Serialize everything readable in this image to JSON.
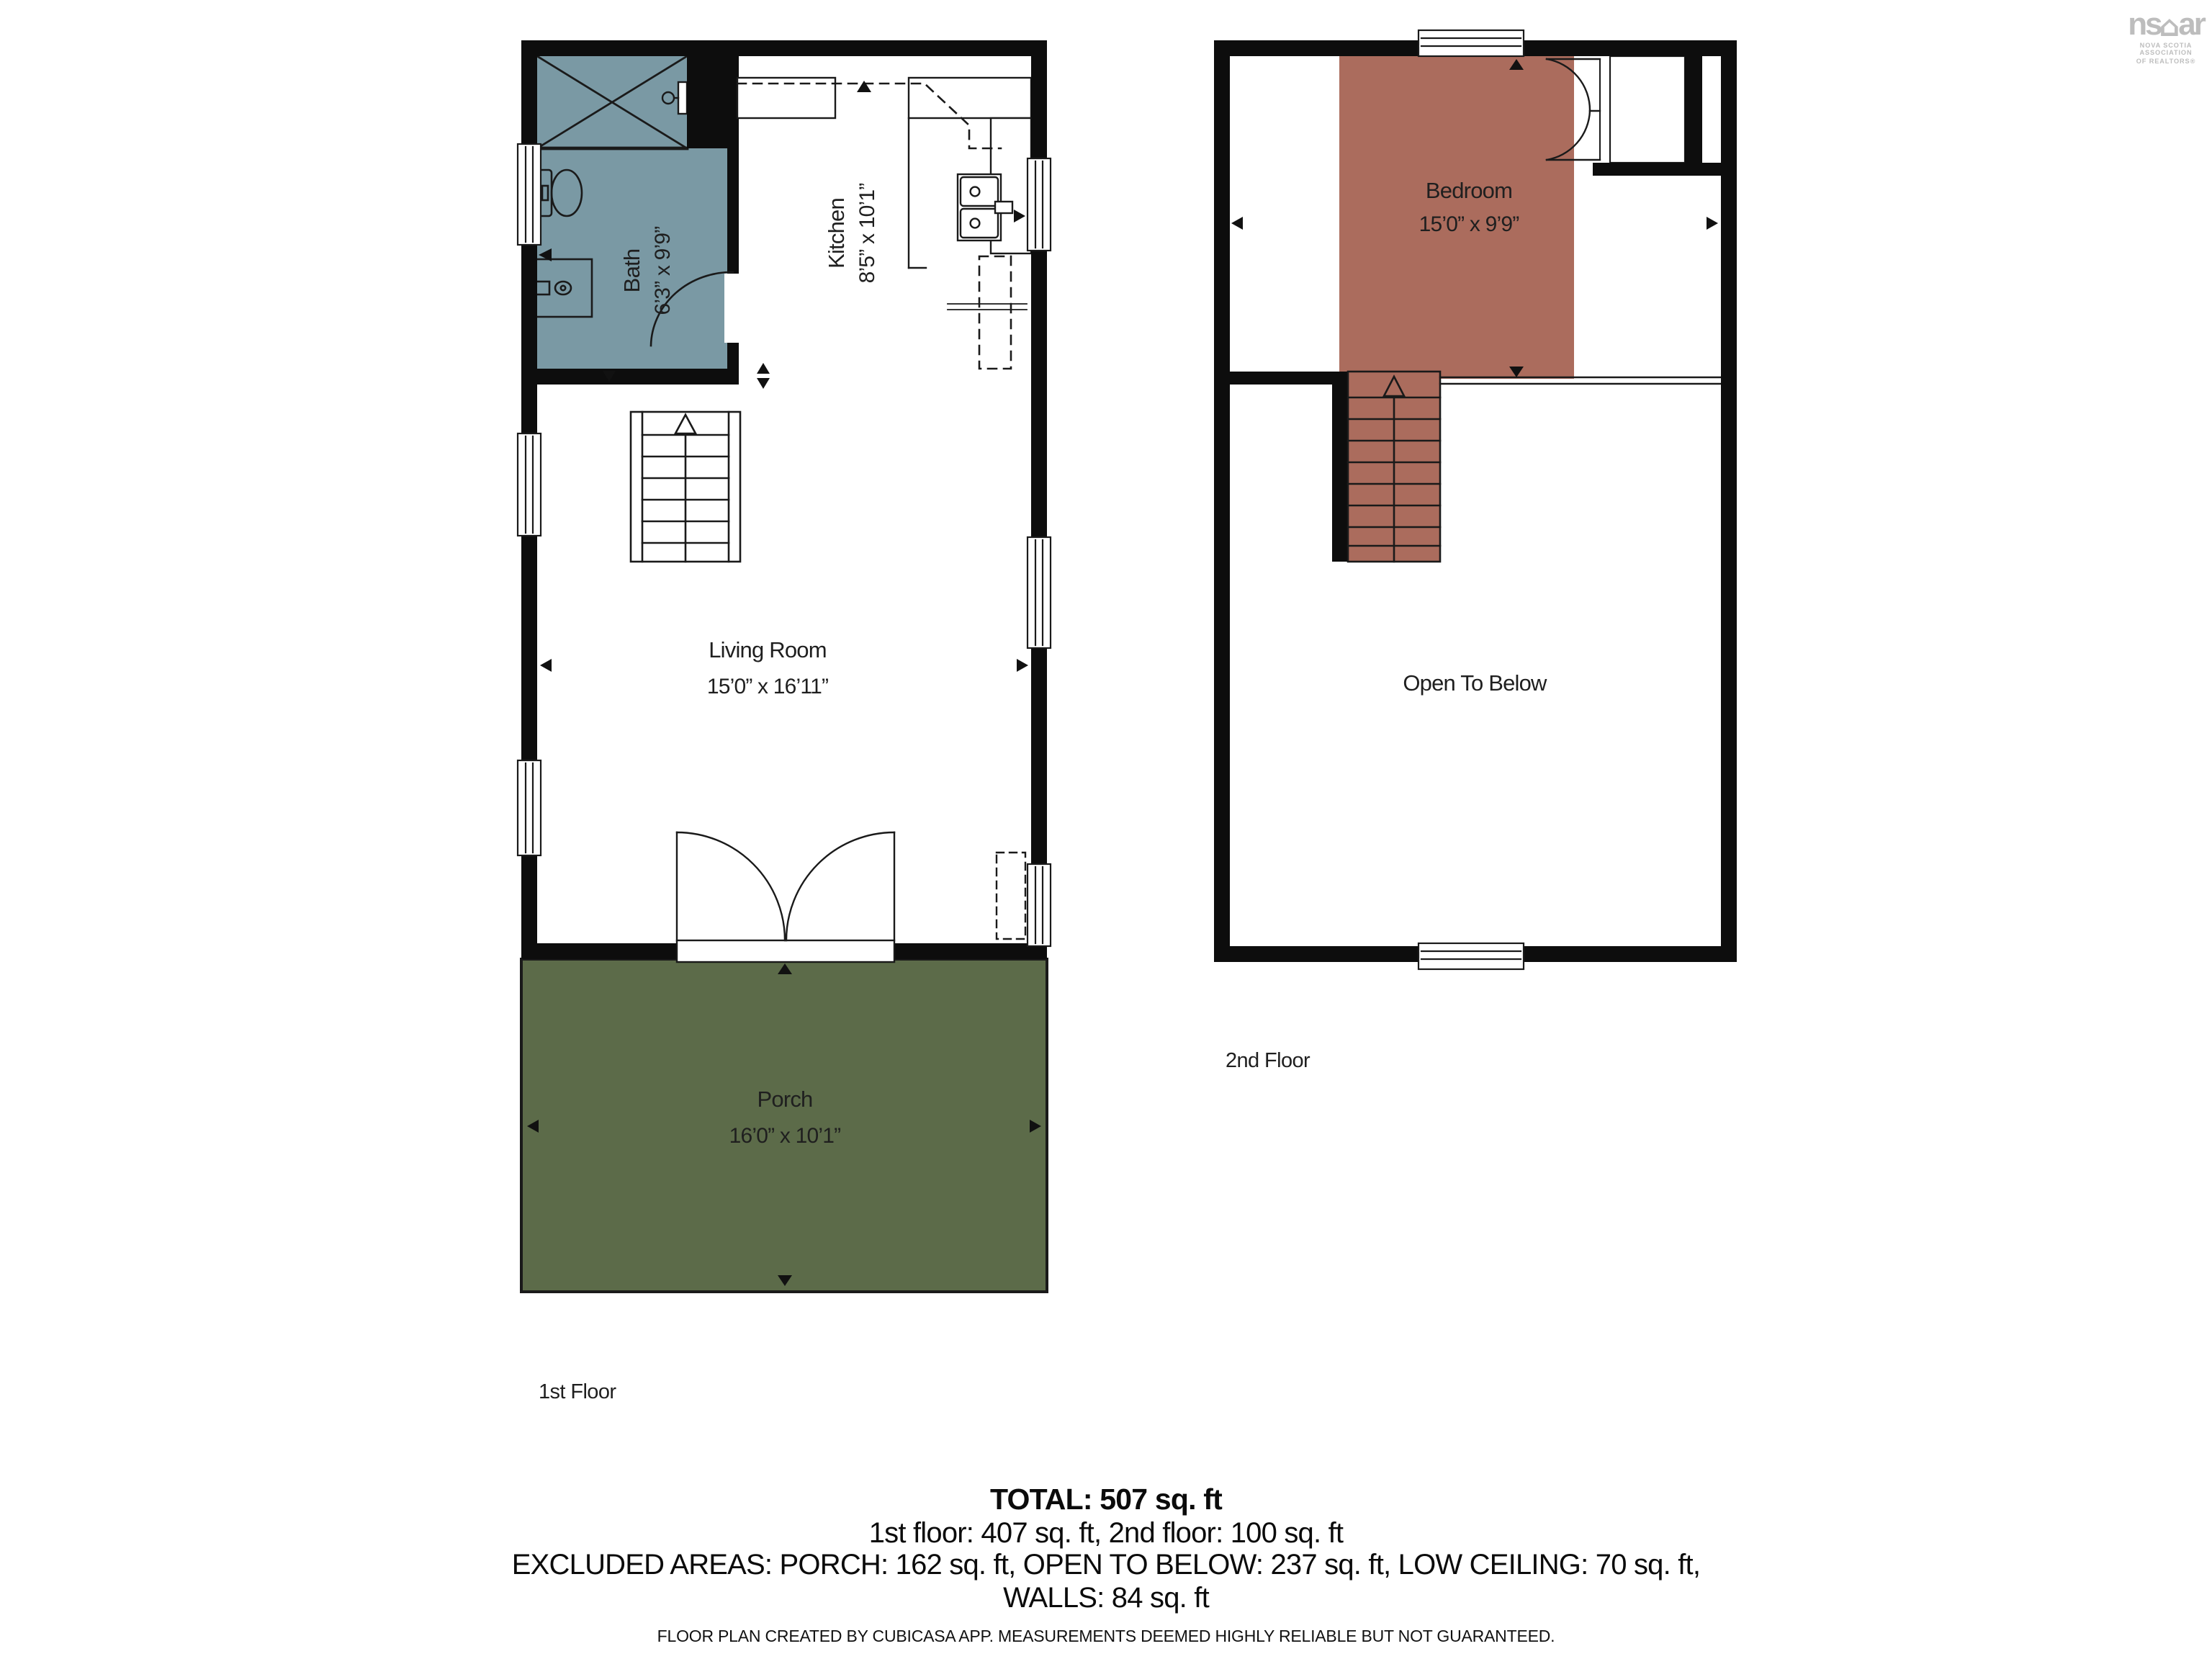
{
  "logo": {
    "text_left": "ns",
    "text_right": "ar",
    "subtext1": "NOVA SCOTIA ASSOCIATION",
    "subtext2": "OF REALTORS®"
  },
  "floors": {
    "first": {
      "label": "1st Floor",
      "rooms": {
        "bath": {
          "name": "Bath",
          "dims": "6’3” x 9’9”"
        },
        "kitchen": {
          "name": "Kitchen",
          "dims": "8’5” x 10’1”"
        },
        "living": {
          "name": "Living Room",
          "dims": "15’0” x 16’11”"
        },
        "porch": {
          "name": "Porch",
          "dims": "16’0” x 10’1”"
        }
      }
    },
    "second": {
      "label": "2nd Floor",
      "rooms": {
        "bedroom": {
          "name": "Bedroom",
          "dims": "15’0” x 9’9”"
        },
        "open": {
          "name": "Open To Below"
        }
      }
    }
  },
  "summary": {
    "total": "TOTAL: 507 sq. ft",
    "floors_line": "1st floor: 407 sq. ft, 2nd floor: 100 sq. ft",
    "excluded_line1": "EXCLUDED AREAS: PORCH: 162 sq. ft, OPEN TO BELOW: 237 sq. ft, LOW CEILING: 70 sq. ft,",
    "excluded_line2": "WALLS: 84 sq. ft",
    "disclaimer": "FLOOR PLAN CREATED BY CUBICASA APP. MEASUREMENTS DEEMED HIGHLY RELIABLE BUT NOT GUARANTEED."
  },
  "colors": {
    "bath": "#7a99a4",
    "bedroom": "#ab6c5d",
    "porch": "#5c6b49",
    "wall": "#0d0d0d",
    "line": "#1a1a1a",
    "logo_gray": "#bdbdbd"
  }
}
